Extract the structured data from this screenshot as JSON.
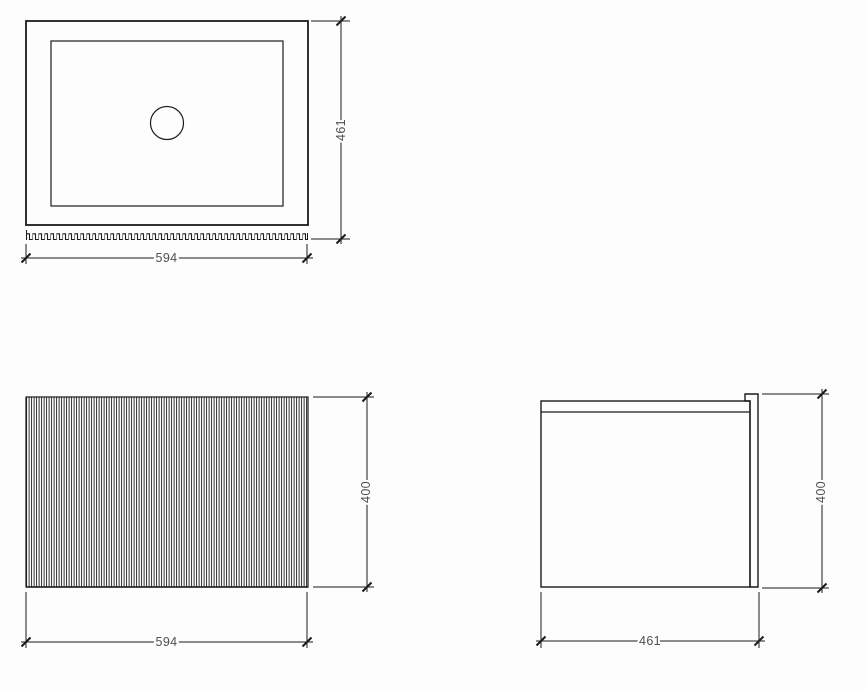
{
  "colors": {
    "background": "#fdfdfd",
    "line": "#1b1b1b",
    "text": "#4f4f4f"
  },
  "views": {
    "top": {
      "width_label": "594",
      "height_label": "461"
    },
    "front": {
      "width_label": "594",
      "height_label": "400"
    },
    "side": {
      "width_label": "461",
      "height_label": "400"
    }
  }
}
